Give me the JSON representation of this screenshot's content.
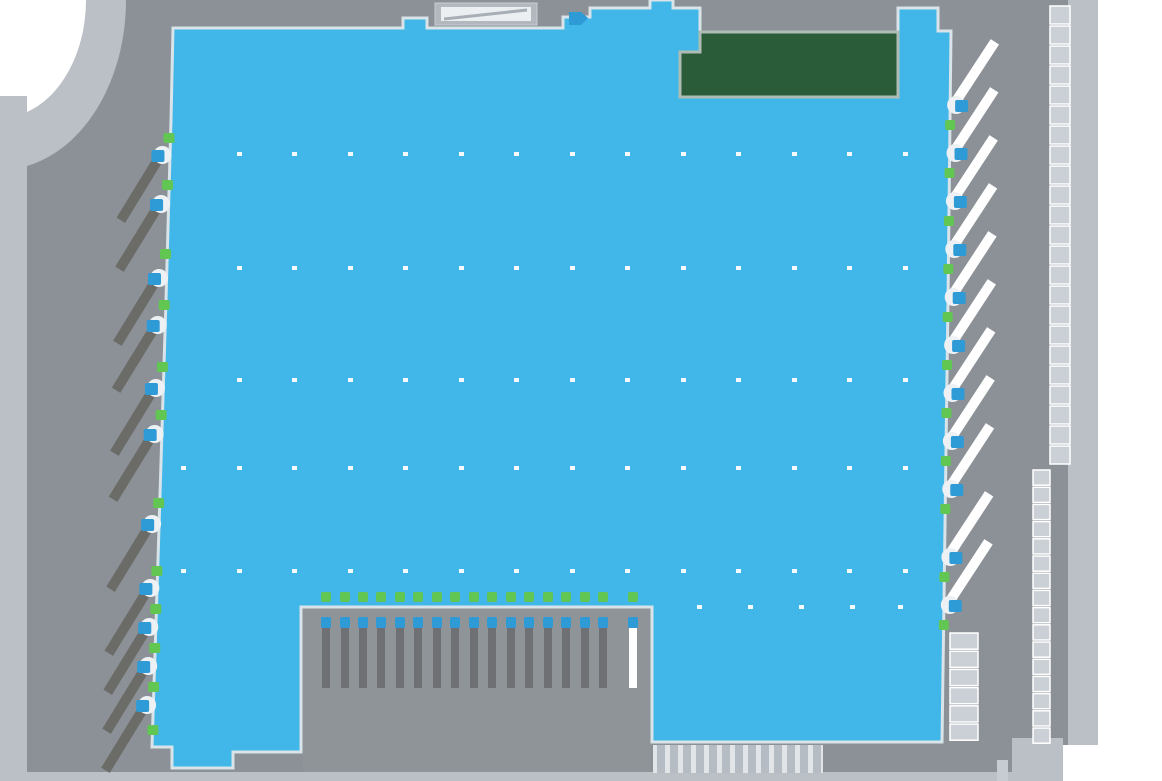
{
  "map": {
    "canvas": {
      "width": 1162,
      "height": 781
    },
    "colors": {
      "bg": "#8B9196",
      "court": "#8F9499",
      "road": "#BBC0C6",
      "offmap_white": "#FFFFFF",
      "floor": "#41B6E8",
      "floor_border": "#D8E4E9",
      "notch": "#EDF1F3",
      "office_fill": "#2A5C39",
      "office_border": "#AEBDB4",
      "green_marker": "#62C653",
      "dock_blue": "#2E9AD6",
      "trailer_dark": "#6B6B68",
      "trailer_white": "#FFFFFF",
      "ladder_cell": "#CBD0D6",
      "ladder_line": "#FFFFFF",
      "court_bar": "#6E7073",
      "court_bar_empty": "#FFFFFF",
      "strip_bg": "#E2E5E8",
      "strip_bar": "#B6BCC3",
      "column_dot": "#FFFFFF",
      "canopy_frame": "#B2B8BE",
      "canopy_inner": "#ECEFF1",
      "canopy_stripe": "#A7AEB5",
      "corner_box": "#C7CCD2"
    },
    "building": {
      "outline": [
        [
          173,
          28
        ],
        [
          403,
          28
        ],
        [
          403,
          18
        ],
        [
          427,
          18
        ],
        [
          427,
          28
        ],
        [
          563,
          28
        ],
        [
          563,
          17
        ],
        [
          590,
          17
        ],
        [
          590,
          8
        ],
        [
          650,
          8
        ],
        [
          650,
          0
        ],
        [
          673,
          0
        ],
        [
          673,
          8
        ],
        [
          700,
          8
        ],
        [
          700,
          32
        ],
        [
          898,
          32
        ],
        [
          898,
          8
        ],
        [
          938,
          8
        ],
        [
          938,
          31
        ],
        [
          951,
          31
        ],
        [
          948,
          300
        ],
        [
          944,
          600
        ],
        [
          942,
          742
        ],
        [
          652,
          742
        ],
        [
          652,
          607
        ],
        [
          301,
          607
        ],
        [
          301,
          752
        ],
        [
          233,
          752
        ],
        [
          233,
          768
        ],
        [
          172,
          768
        ],
        [
          172,
          747
        ],
        [
          152,
          747
        ],
        [
          158,
          560
        ],
        [
          166,
          300
        ],
        [
          171,
          120
        ]
      ],
      "border_width": 3
    },
    "office_block": {
      "outline": [
        [
          680,
          52
        ],
        [
          700,
          52
        ],
        [
          700,
          32
        ],
        [
          898,
          32
        ],
        [
          898,
          97
        ],
        [
          680,
          97
        ]
      ]
    },
    "canopy": {
      "outer": [
        435,
        3,
        102,
        22
      ],
      "inner": [
        441,
        7,
        90,
        14
      ],
      "stripe": [
        444,
        19,
        527,
        10
      ]
    },
    "entrance_arrow": [
      [
        569,
        12
      ],
      [
        581,
        12
      ],
      [
        588,
        18
      ],
      [
        581,
        25
      ],
      [
        569,
        25
      ]
    ],
    "column_grid": {
      "dot_w": 5,
      "dot_h": 4,
      "rows": [
        {
          "y": 152,
          "xs": [
            237,
            292,
            348,
            403,
            459,
            514,
            570,
            625,
            681,
            736,
            792,
            847,
            903
          ]
        },
        {
          "y": 266,
          "xs": [
            237,
            292,
            348,
            403,
            459,
            514,
            570,
            625,
            681,
            736,
            792,
            847,
            903
          ]
        },
        {
          "y": 378,
          "xs": [
            237,
            292,
            348,
            403,
            459,
            514,
            570,
            625,
            681,
            736,
            792,
            847,
            903
          ]
        },
        {
          "y": 466,
          "xs": [
            181,
            237,
            292,
            348,
            403,
            459,
            514,
            570,
            625,
            681,
            736,
            792,
            847,
            903
          ]
        },
        {
          "y": 569,
          "xs": [
            181,
            237,
            292,
            348,
            403,
            459,
            514,
            570,
            625,
            681,
            736,
            792,
            847,
            903
          ]
        },
        {
          "y": 605,
          "xs": [
            697,
            748,
            799,
            850,
            898
          ]
        }
      ]
    },
    "left_edge": {
      "x0": 170,
      "y0": 130,
      "x1": 153,
      "y1": 740,
      "docks": [
        {
          "g": 133,
          "b": 150
        },
        {
          "g": 180,
          "b": 199
        },
        {
          "g": 249,
          "b": 273
        },
        {
          "g": 300,
          "b": 320
        },
        {
          "g": 362,
          "b": 383
        },
        {
          "g": 410,
          "b": 429
        },
        {
          "g": 498,
          "b": 519
        },
        {
          "g": 566,
          "b": 583
        },
        {
          "g": 604,
          "b": 622
        },
        {
          "g": 643,
          "b": 661
        },
        {
          "g": 682,
          "b": 700
        },
        {
          "g": 725,
          "b": null
        }
      ],
      "trailer": {
        "dx": -38,
        "dy": 62,
        "width": 10
      }
    },
    "right_edge": {
      "x0": 951,
      "y0": 31,
      "x1": 942,
      "y1": 742,
      "docks": [
        {
          "b": 100
        },
        {
          "b": 148
        },
        {
          "b": 196
        },
        {
          "b": 244
        },
        {
          "b": 292
        },
        {
          "b": 340
        },
        {
          "b": 388
        },
        {
          "b": 436
        },
        {
          "b": 484
        },
        {
          "b": 552
        },
        {
          "b": 600
        }
      ],
      "green_offset": 20,
      "trailer": {
        "dx": 34,
        "dy": -52,
        "width": 10
      }
    },
    "truck_court": {
      "left": 301,
      "right": 652,
      "top": 607,
      "bottom": 772,
      "door_xs": [
        321,
        340,
        358,
        376,
        395,
        413,
        432,
        450,
        469,
        487,
        506,
        524,
        543,
        561,
        580,
        598,
        628
      ],
      "green_y": 592,
      "blue_y": 617,
      "bar_top": 628,
      "bar_h": 60,
      "empty_dock_index": 16
    },
    "parking_strips": [
      {
        "x": 1050,
        "w": 20,
        "y": 6,
        "y2": 470,
        "step": 20
      },
      {
        "x": 1033,
        "w": 17,
        "y": 470,
        "y2": 745,
        "step": 17.2
      },
      {
        "x": 950,
        "w": 28,
        "y": 633,
        "y2": 742,
        "step": 18.2
      }
    ],
    "bottom_parking": {
      "x": 653,
      "y": 745,
      "w": 170,
      "h": 28,
      "bar_w": 8,
      "step": 13
    },
    "roads": {
      "corner_band": {
        "rx": 126,
        "ry": 170
      },
      "corner_white": {
        "rx": 86,
        "ry": 118
      },
      "left_strip": [
        0,
        96,
        27,
        676
      ],
      "right_strip": [
        1068,
        0,
        30,
        772
      ],
      "bottom_strip": [
        0,
        772,
        1063,
        9
      ],
      "right_white": [
        1098,
        0,
        64,
        781
      ],
      "bottom_right_white": [
        1063,
        745,
        99,
        36
      ],
      "bottom_right_pad": [
        1012,
        738,
        51,
        43
      ],
      "bottom_right_box": [
        997,
        760,
        11,
        21
      ]
    }
  }
}
